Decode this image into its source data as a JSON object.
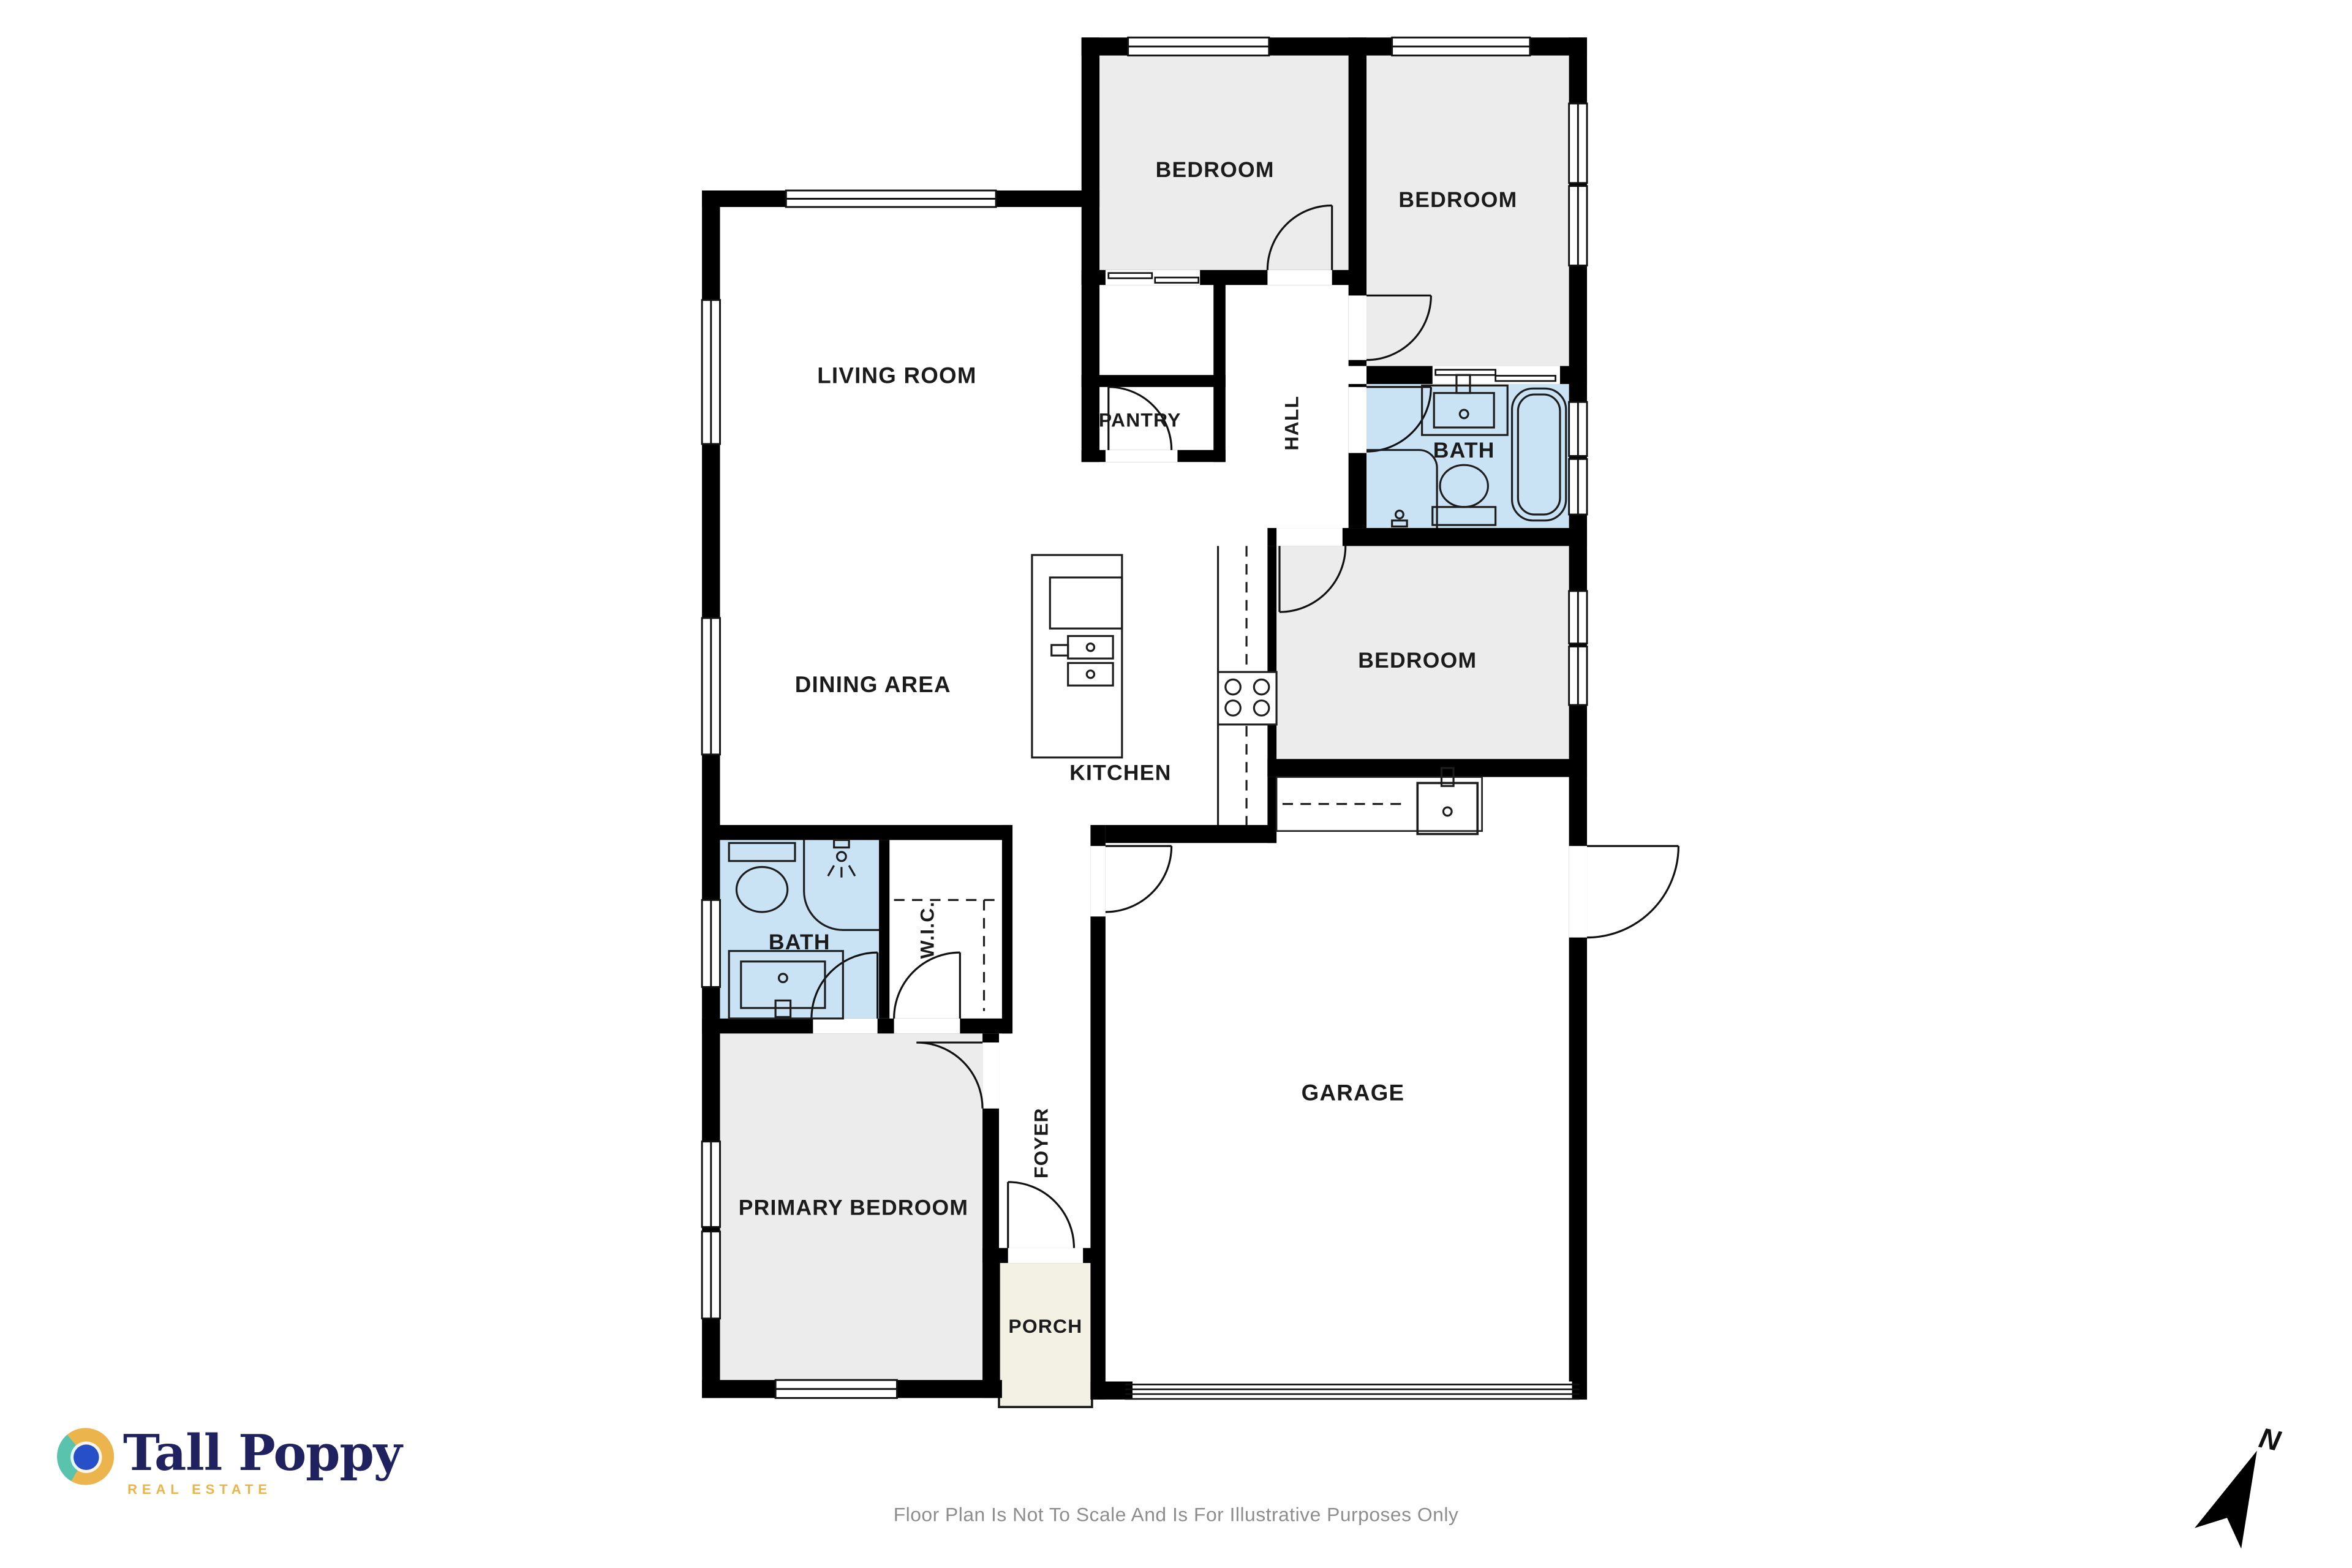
{
  "plan": {
    "rooms": {
      "living": {
        "label": "LIVING ROOM"
      },
      "dining": {
        "label": "DINING AREA"
      },
      "kitchen": {
        "label": "KITCHEN"
      },
      "pantry": {
        "label": "PANTRY"
      },
      "hall": {
        "label": "HALL"
      },
      "bedroom_top_left": {
        "label": "BEDROOM"
      },
      "bedroom_top_right": {
        "label": "BEDROOM"
      },
      "bedroom_middle": {
        "label": "BEDROOM"
      },
      "bath_hall": {
        "label": "BATH"
      },
      "bath_primary": {
        "label": "BATH"
      },
      "wic": {
        "label": "W.I.C."
      },
      "foyer": {
        "label": "FOYER"
      },
      "primary": {
        "label": "PRIMARY BEDROOM"
      },
      "garage": {
        "label": "GARAGE"
      },
      "porch": {
        "label": "PORCH"
      }
    },
    "colors": {
      "wall": "#000000",
      "bedroom_gray": "#ececec",
      "bath_blue": "#c9e3f5",
      "porch_cream": "#f3f1e3",
      "label_text": "#1b1b1b"
    }
  },
  "branding": {
    "logo_text": "Tall Poppy",
    "logo_subtext": "REAL ESTATE",
    "colors": {
      "navy": "#20215f",
      "gold": "#e9b44c",
      "teal": "#59c3ad",
      "blue": "#2750c8"
    }
  },
  "footer": {
    "disclaimer": "Floor Plan Is Not To Scale And Is For Illustrative Purposes Only"
  },
  "compass": {
    "label": "N"
  }
}
